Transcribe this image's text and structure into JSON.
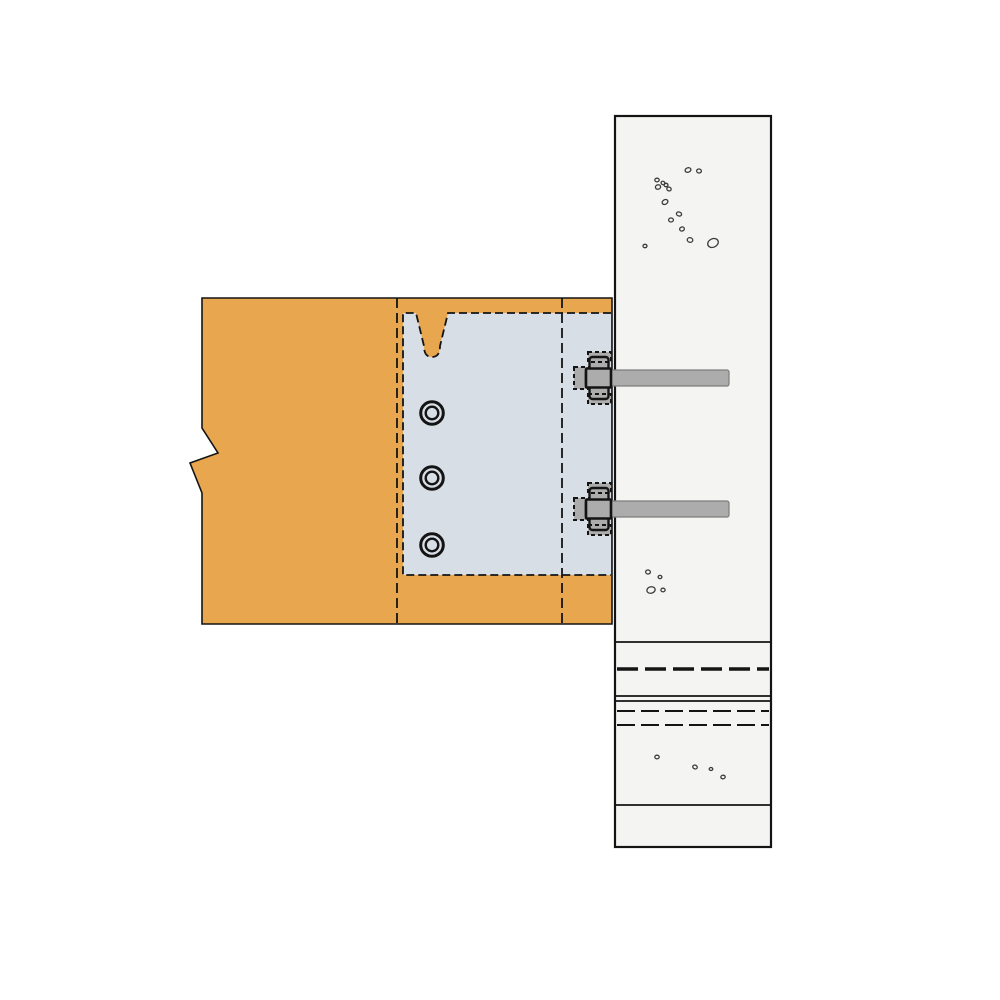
{
  "meta": {
    "description": "Technical detail drawing: timber beam fixed to a concrete column with a concealed steel connector plate, three dowel pins and two anchor bolts with hex nuts. No visible text in the drawing.",
    "drawing_title": ""
  },
  "canvas": {
    "w": 1000,
    "h": 1000,
    "bg": "#FFFFFF"
  },
  "colors": {
    "wood": "#E8A64E",
    "plate": "#D8DEE5",
    "concrete": "#F4F4F2",
    "steel": "#ACACAC",
    "steel_edge": "#7D7D7D",
    "ink": "#141414",
    "speckle": "#3C3C3C"
  },
  "beam": {
    "outline": [
      [
        202,
        298
      ],
      [
        612,
        298
      ],
      [
        612,
        624
      ],
      [
        202,
        624
      ],
      [
        202,
        493
      ],
      [
        190,
        463
      ],
      [
        218,
        453
      ],
      [
        202,
        428
      ]
    ],
    "stroke_w": 1.6,
    "dashed_verticals": {
      "xs": [
        397,
        562
      ],
      "y1": 298,
      "y2": 624,
      "dash": "10 5",
      "width": 1.8
    }
  },
  "plate": {
    "left": 403,
    "top": 313,
    "right": 611,
    "bottom": 575,
    "dash": "8 4",
    "stroke_w": 1.8,
    "notch": {
      "x1": 416,
      "x2": 448,
      "taper_x1": 424,
      "taper_x2": 440,
      "y_top": 313,
      "y_mid": 346,
      "y_bottom": 357,
      "cx": 432
    }
  },
  "dowels": {
    "cx": 432,
    "cys": [
      413,
      478,
      545
    ],
    "r_outer": 11.3,
    "r_inner": 6.3,
    "w_outer": 3,
    "w_inner": 2.4
  },
  "column": {
    "left": 615,
    "top": 116,
    "right": 771,
    "bottom": 847,
    "border_w": 2.2,
    "solid_lines": {
      "ys": [
        642,
        696,
        701,
        805
      ],
      "width": 1.8
    },
    "thick_dashed": {
      "ys": [
        669
      ],
      "width": 3.5,
      "dash": "21 7"
    },
    "thin_dashed": {
      "ys": [
        711,
        725
      ],
      "width": 2,
      "dash": "18 6"
    }
  },
  "bolts": {
    "centers_y": [
      378,
      509
    ],
    "rod": {
      "x1": 585,
      "x2": 729,
      "half_h": 8,
      "stroke_w": 1.2
    },
    "washer": {
      "x": 574,
      "w": 15,
      "half_h": 11,
      "dash": "4 3",
      "stroke_w": 2
    },
    "nut": {
      "mid_x": 586,
      "mid_w": 25,
      "mid_half_h": 9.5,
      "mid_stroke_w": 2.6,
      "cham_x": 589.5,
      "cham_w": 19,
      "cham_y_off": 21,
      "cham_h": 14,
      "cham_stroke_w": 2.4
    },
    "hidden_boxes": {
      "x": 588,
      "w": 23,
      "y_off": 16,
      "h": 10,
      "dash": "4 3",
      "stroke_w": 2
    }
  },
  "speckles": [
    [
      688,
      170,
      3,
      2.2,
      -20
    ],
    [
      699,
      171,
      2.4,
      2,
      10
    ],
    [
      657,
      180,
      2.2,
      1.8,
      0
    ],
    [
      663,
      183,
      2,
      1.7,
      30
    ],
    [
      658,
      187,
      2.6,
      2.2,
      -15
    ],
    [
      666,
      185,
      2,
      1.7,
      0
    ],
    [
      669,
      189,
      2.2,
      1.9,
      20
    ],
    [
      665,
      202,
      3,
      2.3,
      -30
    ],
    [
      679,
      214,
      2.6,
      2,
      15
    ],
    [
      671,
      220,
      2.4,
      2,
      0
    ],
    [
      682,
      229,
      2.4,
      2,
      -20
    ],
    [
      690,
      240,
      2.8,
      2.3,
      10
    ],
    [
      713,
      243,
      5.5,
      4.2,
      -25
    ],
    [
      645,
      246,
      2,
      1.7,
      0
    ],
    [
      648,
      572,
      2.4,
      2,
      10
    ],
    [
      660,
      577,
      1.9,
      1.6,
      0
    ],
    [
      651,
      590,
      4.2,
      3.2,
      -15
    ],
    [
      663,
      590,
      2.1,
      1.8,
      0
    ],
    [
      657,
      757,
      2.2,
      1.8,
      0
    ],
    [
      695,
      767,
      2.3,
      1.9,
      20
    ],
    [
      711,
      769,
      1.8,
      1.5,
      0
    ],
    [
      723,
      777,
      2.2,
      1.8,
      -10
    ]
  ]
}
